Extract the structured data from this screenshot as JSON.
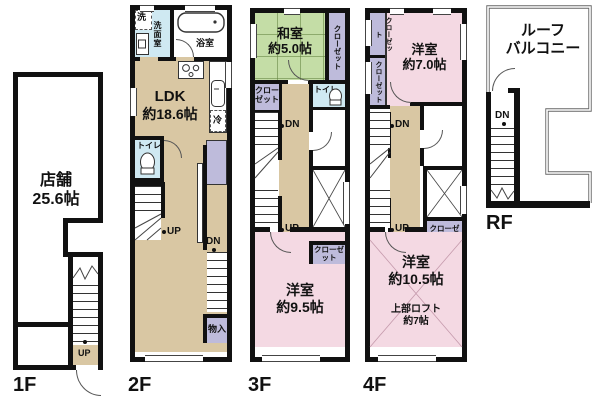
{
  "colors": {
    "wall": "#111111",
    "floor_tan": "#d9c7a3",
    "room_pink": "#f4d9e3",
    "tatami_green": "#c4dda6",
    "closet_purple": "#bebbdb",
    "wet_blue": "#cfe9f2"
  },
  "floors": {
    "f1": {
      "label": "1F",
      "room": "店舗",
      "size": "25.6帖",
      "up": "UP"
    },
    "f2": {
      "label": "2F",
      "washer": "洗",
      "washroom": "洗面室",
      "bath": "浴室",
      "ldk": "LDK",
      "ldk_size": "約18.6帖",
      "fridge": "冷",
      "toilet": "トイレ",
      "up": "UP",
      "dn": "DN",
      "storage": "物入"
    },
    "f3": {
      "label": "3F",
      "washitsu": "和室",
      "washitsu_size": "約5.0帖",
      "closet_right": "クローゼット",
      "closet_left": "クローゼット",
      "toilet": "トイレ",
      "dn": "DN",
      "up": "UP",
      "closet_small": "クローゼット",
      "room": "洋室",
      "room_size": "約9.5帖"
    },
    "f4": {
      "label": "4F",
      "closet_a": "クローゼット",
      "closet_b": "クローゼット",
      "room_top": "洋室",
      "room_top_size": "約7.0帖",
      "dn": "DN",
      "up": "UP",
      "closet_small": "クローゼット",
      "room": "洋室",
      "room_size": "約10.5帖",
      "loft": "上部ロフト",
      "loft_size": "約7帖"
    },
    "rf": {
      "label": "RF",
      "balcony_line1": "ルーフ",
      "balcony_line2": "バルコニー",
      "dn": "DN"
    }
  }
}
